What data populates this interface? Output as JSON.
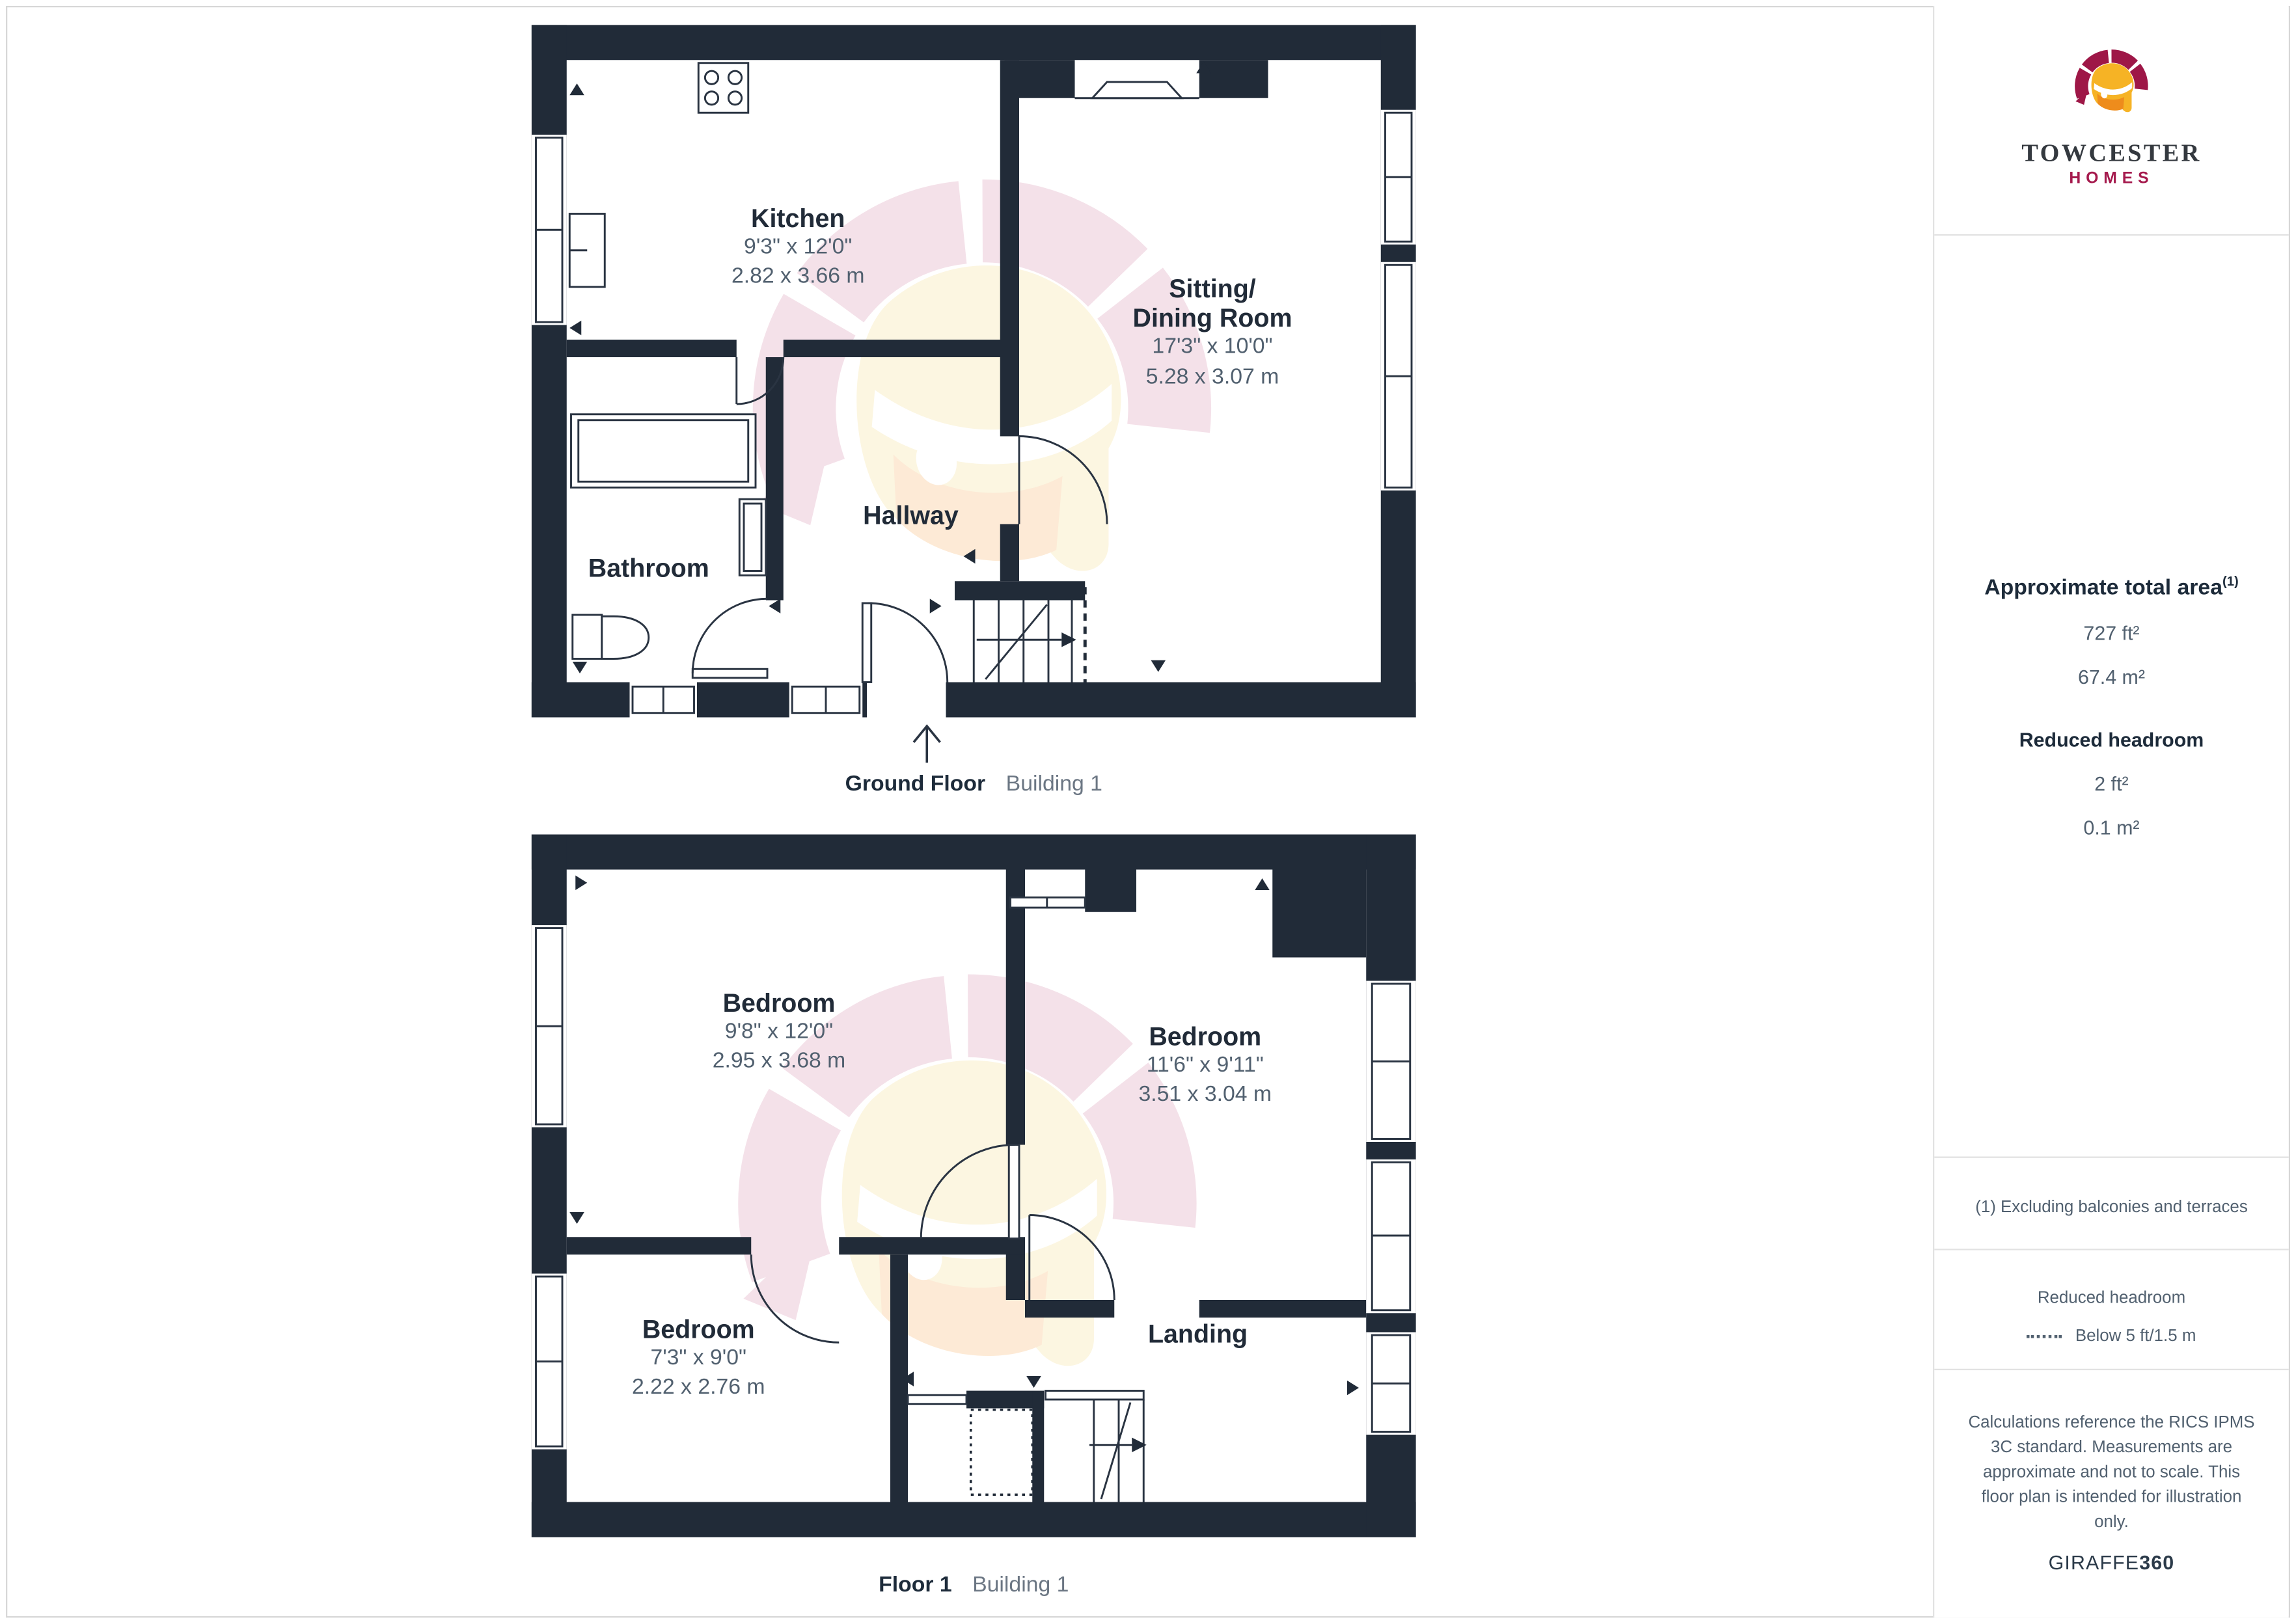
{
  "sidebar": {
    "logo": {
      "brand": "TOWCESTER",
      "sub": "HOMES"
    },
    "area": {
      "title": "Approximate total area",
      "superscript": "(1)",
      "value_ft": "727 ft²",
      "value_m": "67.4 m²",
      "headroom_title": "Reduced headroom",
      "headroom_ft": "2 ft²",
      "headroom_m": "0.1 m²"
    },
    "footnote": "(1) Excluding balconies and terraces",
    "legend": {
      "title": "Reduced headroom",
      "item": "Below 5 ft/1.5 m"
    },
    "disclaimer": "Calculations reference the RICS IPMS 3C standard. Measurements are approximate and not to scale. This floor plan is intended for illustration only.",
    "brand_footer": {
      "name": "GIRAFFE",
      "suffix": "360"
    }
  },
  "floors": [
    {
      "label": "Ground Floor",
      "building": "Building 1",
      "rooms": [
        {
          "name": "Kitchen",
          "imperial": "9'3\" x 12'0\"",
          "metric": "2.82 x 3.66 m"
        },
        {
          "name": "Sitting/",
          "name2": "Dining Room",
          "imperial": "17'3\" x 10'0\"",
          "metric": "5.28 x 3.07 m"
        },
        {
          "name": "Hallway"
        },
        {
          "name": "Bathroom"
        }
      ]
    },
    {
      "label": "Floor 1",
      "building": "Building 1",
      "rooms": [
        {
          "name": "Bedroom",
          "imperial": "9'8\" x 12'0\"",
          "metric": "2.95 x 3.68 m"
        },
        {
          "name": "Bedroom",
          "imperial": "11'6\" x 9'11\"",
          "metric": "3.51 x 3.04 m"
        },
        {
          "name": "Bedroom",
          "imperial": "7'3\" x 9'0\"",
          "metric": "2.22 x 2.76 m"
        },
        {
          "name": "Landing"
        }
      ]
    }
  ],
  "colors": {
    "wall": "#212b38",
    "text_dark": "#1d2b3a",
    "text_dim": "#51606f",
    "brand_crimson": "#a51a4d",
    "brand_orange": "#f6b325",
    "watermark_pink": "#ecc9d8",
    "watermark_cream": "#f9eec9",
    "watermark_peach": "#fbd9b4"
  }
}
